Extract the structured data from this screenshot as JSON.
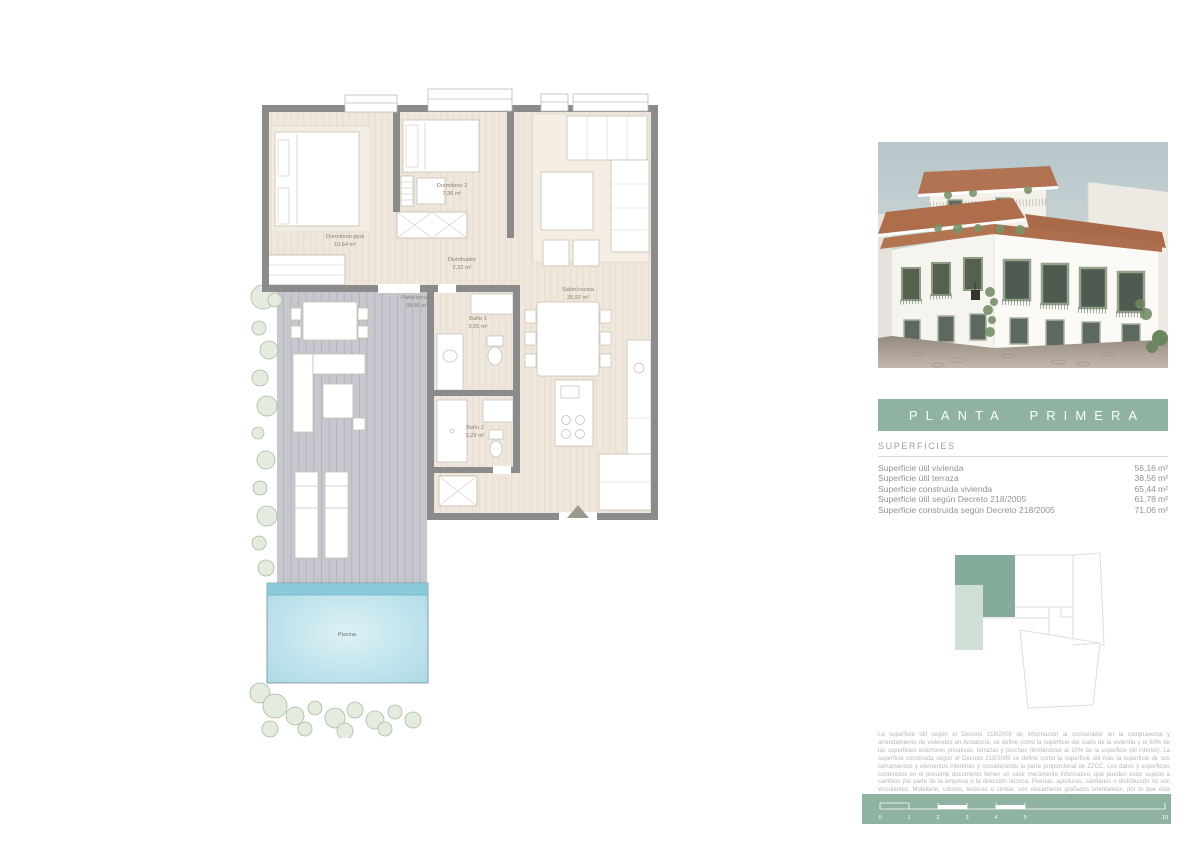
{
  "banner": {
    "title": "PLANTA PRIMERA"
  },
  "surfaces": {
    "heading": "SUPERFICIES",
    "unit": "m²",
    "rows": [
      {
        "label": "Superficie útil vivienda",
        "value": "56,16"
      },
      {
        "label": "Superficie útil terraza",
        "value": "38,56"
      },
      {
        "label": "Superficie construida vivienda",
        "value": "65,44"
      },
      {
        "label": "Superficie útil según Decreto 218/2005",
        "value": "61,78"
      },
      {
        "label": "Superficie construida según Decreto 218/2005",
        "value": "71,06"
      }
    ]
  },
  "plan": {
    "rooms": [
      {
        "name": "Dormitorio ppal",
        "area": "10,64 m²"
      },
      {
        "name": "Dormitorio 2",
        "area": "7,36 m²"
      },
      {
        "name": "Distribuidor",
        "area": "2,32 m²"
      },
      {
        "name": "Salón/cocina",
        "area": "20,92 m²"
      },
      {
        "name": "Patio/terraza",
        "area": "38,56 m²"
      },
      {
        "name": "Baño 1",
        "area": "3,65 m²"
      },
      {
        "name": "Baño 2",
        "area": "3,29 m²"
      }
    ],
    "pool_label": "Piscina"
  },
  "sitemap": {
    "description": "unit-location-key"
  },
  "disclaimer": "La superficie útil según el Decreto 218/2005 de información al consumidor en la compraventa y arrendamiento de viviendas en Andalucía, se define como la superficie del suelo de la vivienda y el 50% de las superficies exteriores privativas, terrazas y porches (limitándose al 10% de la superficie útil interior). La superficie construida según el Decreto 218/2005 se define como la superficie útil más la superficie de sus cerramientos y elementos interiores y considerando la parte proporcional de ZZCC. Los datos y superficies contenidos en el presente documento tienen un valor meramente informativo, que pueden estar sujetos a cambios por parte de la empresa o la dirección técnica. Puertas, aperturas, sanitarios o distribución no son vinculantes. Mobiliario, colores, texturas o similar, son únicamente grafiados orientativos, por lo que esta documentación no puede ser considerada como una forma de contrato u obligación.",
  "scalebar": {
    "ticks": [
      "0",
      "1",
      "2",
      "3",
      "4",
      "5",
      "10"
    ]
  },
  "colors": {
    "accent_green": "#8fb2a3",
    "light_green": "#cfdfd6",
    "wall_gray": "#8b8b8b",
    "floor_beige": "#efe7db",
    "deck_gray": "#c7c7ce",
    "pool_blue": "#a5d7e3"
  }
}
